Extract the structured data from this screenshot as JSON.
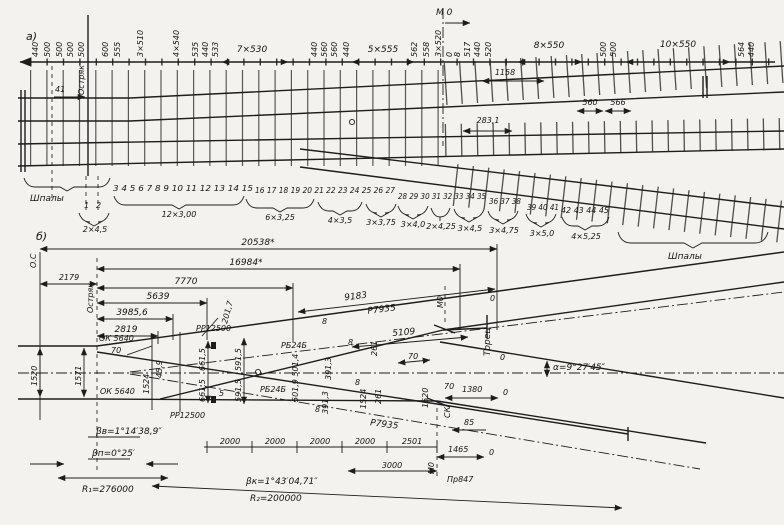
{
  "figure": {
    "part_a_label": "а)",
    "part_b_label": "б)"
  },
  "part_a": {
    "top_labels": [
      "440",
      "500",
      "500",
      "500",
      "500",
      "600",
      "555",
      "3×510",
      "4×540",
      "535",
      "440",
      "533",
      "440",
      "560",
      "560",
      "440",
      "562",
      "558",
      "3×520",
      "0",
      "8",
      "517",
      "440",
      "520",
      "500",
      "500",
      "564",
      "440"
    ],
    "span_labels": [
      "7×530",
      "5×555",
      "8×550",
      "10×550"
    ],
    "mo_label": "М 0",
    "dim_1158": "1158",
    "dim_283": "283,1",
    "dim_560": "560",
    "dim_566": "566",
    "blade_label": "Остряк",
    "blade_dim": "41",
    "sleepers_left": "Шпалы",
    "sleepers_right": "Шпалы",
    "tie_first": [
      "1",
      "2"
    ],
    "tie_number_rows": [
      "3 4 5 6 7 8 9 10 11 12 13 14 15",
      "16 17 18 19 20 21 22 23 24 25 26 27",
      "28 29 30 31 32 33 34 35",
      "36 37 38",
      "39 40 41",
      "42 43 44 45"
    ],
    "tie_groups": [
      "2×4,5",
      "12×3,00",
      "6×3,25",
      "4×3,5",
      "3×3,75",
      "3×4,0",
      "2×4,25",
      "3×4,5",
      "3×4,75",
      "3×5,0",
      "4×5,25"
    ]
  },
  "part_b": {
    "os_label": "О.С",
    "blade_label": "Остряк",
    "dims_top": [
      "20538*",
      "16984*",
      "7770",
      "5639",
      "3985,6",
      "2819"
    ],
    "dim_2179": "2179",
    "dim_201_7": "201,7",
    "rr_upper": "РР12500",
    "rr_lower": "РР12500",
    "ok_upper": "ОК 5640",
    "ok_lower": "ОК 5640",
    "ok_70": "70",
    "v_1520": "1520",
    "v_1571": "1571",
    "v_1524_left": "1524",
    "v_45_9": "45,9",
    "v_661_5a": "661,5",
    "v_661_5b": "661,5",
    "v_591_5a": "591,5",
    "v_591_5b": "591,5",
    "gap_5": "5",
    "rb_upper": "РБ24Б",
    "rb_lower": "РБ24Б",
    "v_501": "501,9 501,4",
    "dim_9183": "9183",
    "rail_upper": "Р7935",
    "rail_lower": "Р7935",
    "dim_5109": "5109",
    "v_261a": "261",
    "v_261b": "261",
    "dim_70_mid": "70",
    "gap_8a": "8",
    "gap_8b": "8",
    "gap_8c": "8",
    "gap_8d": "8",
    "v_391_3a": "391,3",
    "v_391_3b": "391,3",
    "mo_upper": "М0",
    "mo_lower": "М0",
    "torec": "Торец",
    "zero_a": "0",
    "zero_b": "0",
    "zero_c": "0",
    "zero_d": "0",
    "v_1524_right": "1524",
    "v_1520_right": "1520",
    "sk": "СК",
    "dim_85": "85",
    "dim_1380": "1380",
    "dim_70_right": "70",
    "dim_1465": "1465",
    "dims_2000": [
      "2000",
      "2000",
      "2000",
      "2000"
    ],
    "dim_2501": "2501",
    "dim_3000": "3000",
    "pr847": "Пр847",
    "angle_alpha": "α=9°27′45″",
    "beta_v": "βв=1°14′38,9″",
    "beta_p": "βп=0°25′",
    "beta_k": "βк=1°43′04,71″",
    "r1": "R₁=276000",
    "r2": "R₂=200000"
  }
}
